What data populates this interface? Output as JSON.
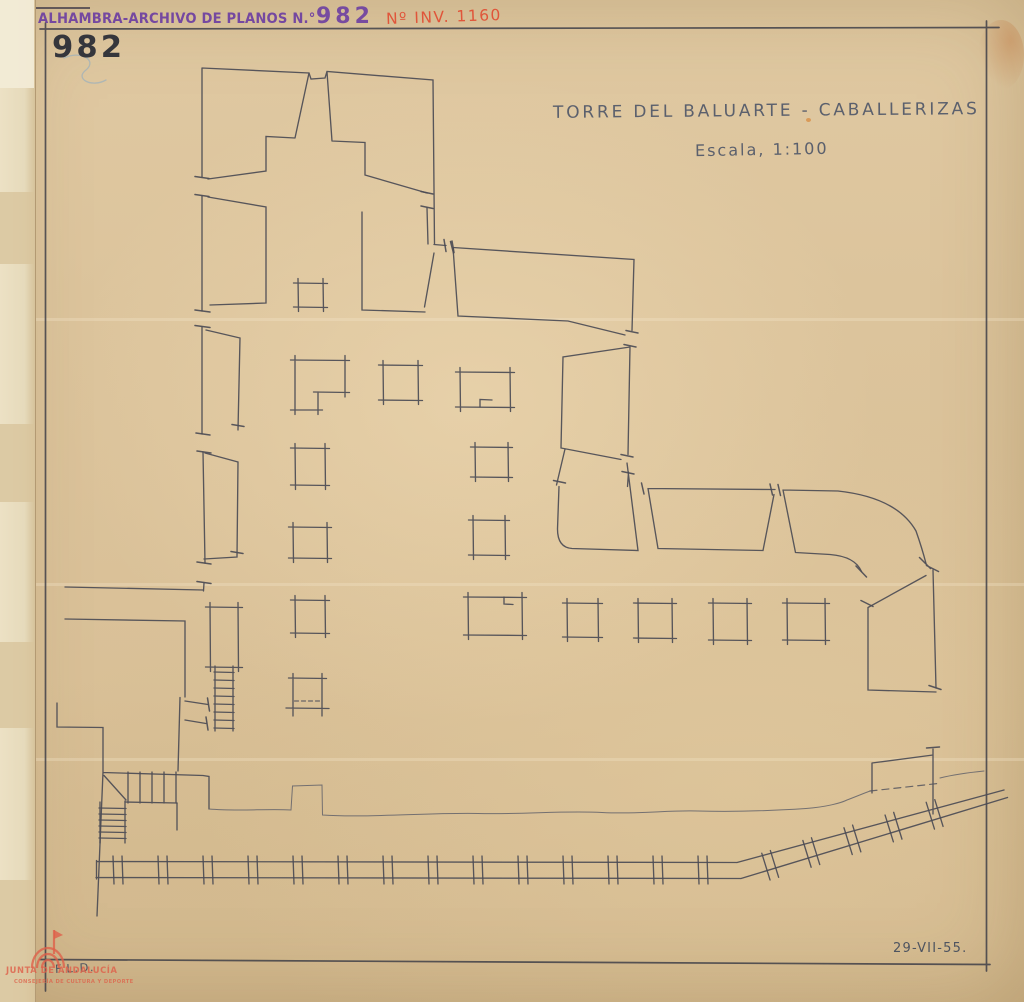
{
  "archive_stamp": {
    "label": "ALHAMBRA-ARCHIVO DE PLANOS N.°",
    "number": "982",
    "inventory": "Nº INV. 1160"
  },
  "sheet": {
    "plan_number": "982",
    "title": "TORRE DEL BALUARTE - CABALLERIZAS",
    "scale_label": "Escala, 1:100",
    "author_initials": "F.L.D.",
    "date": "29-VII-55."
  },
  "watermark": {
    "org": "JUNTA DE ANDALUCÍA",
    "dept": "CONSEJERÍA DE CULTURA Y DEPORTE"
  },
  "colors": {
    "paper": "#dcc49c",
    "pencil": "#4c4c55",
    "stamp_purple": "#6d3fa2",
    "inventory_red": "#e2472e",
    "watermark_salmon": "#de604a",
    "scribble_blue": "#7fa8c9"
  }
}
